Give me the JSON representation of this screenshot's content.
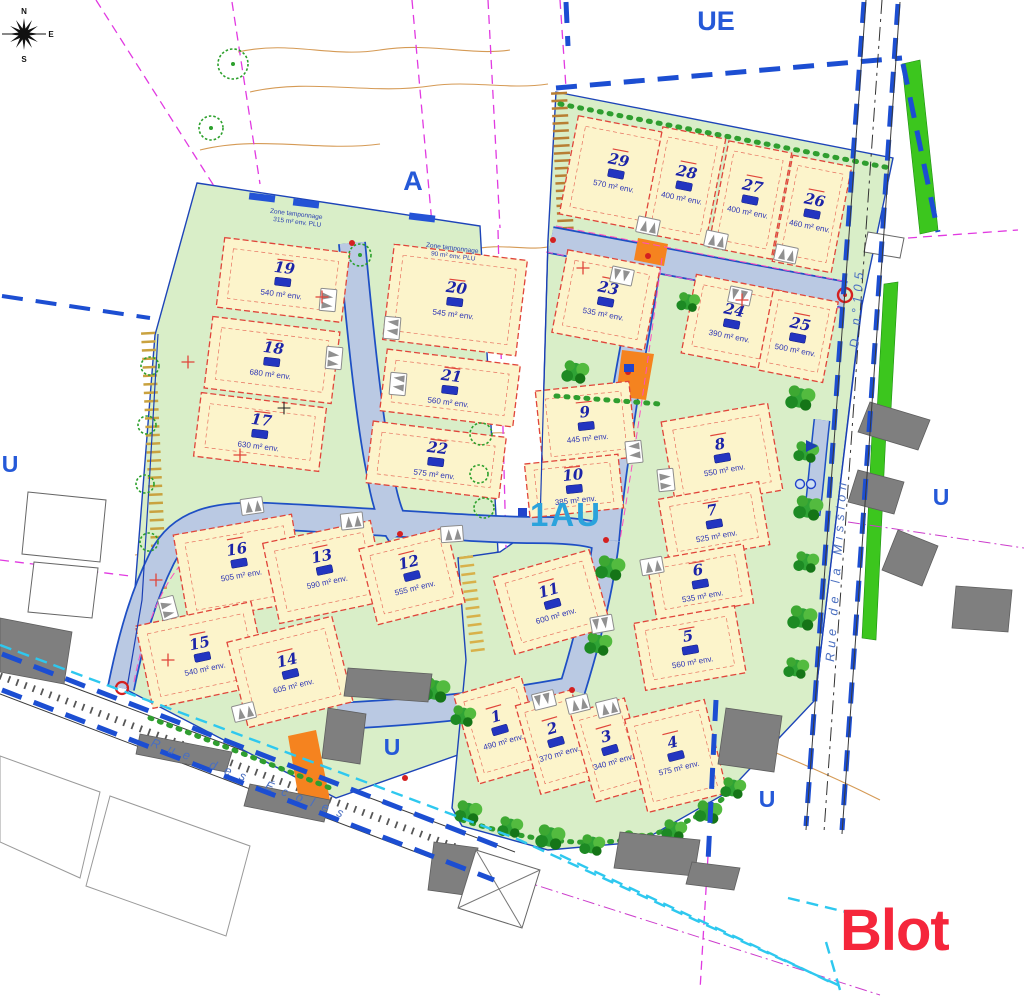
{
  "map": {
    "compass": {
      "n": "N",
      "e": "E",
      "s": "S",
      "o": "O"
    },
    "zones": {
      "ue": "UE",
      "a": "A",
      "u": "U",
      "one_au": "1AU"
    },
    "streets": {
      "ecoles": "Rue des Écoles",
      "mission": "Rue de la Mission",
      "route": "D n°105"
    },
    "annotations": {
      "buffer1_line1": "Zone tamponnage",
      "buffer1_line2": "315 m² env. PLU",
      "buffer2_line1": "Zone tamponnage",
      "buffer2_line2": "90 m² env. PLU"
    },
    "logo": "Blot",
    "colors": {
      "lot_fill": "#fcf4cb",
      "green": "#d9eec8",
      "road": "#bac9e3",
      "blue": "#1e4fc4",
      "red": "#e0453a",
      "magenta": "#e13ae1",
      "cyan": "#2ec8ef",
      "orange": "#f5831f",
      "logo_red": "#f5263b"
    }
  },
  "lots": [
    {
      "num": "1",
      "area": "490 m² env."
    },
    {
      "num": "2",
      "area": "370 m² env."
    },
    {
      "num": "3",
      "area": "340 m² env."
    },
    {
      "num": "4",
      "area": "575 m² env."
    },
    {
      "num": "5",
      "area": "560 m² env."
    },
    {
      "num": "6",
      "area": "535 m² env."
    },
    {
      "num": "7",
      "area": "525 m² env."
    },
    {
      "num": "8",
      "area": "550 m² env."
    },
    {
      "num": "9",
      "area": "445 m² env."
    },
    {
      "num": "10",
      "area": "385 m² env."
    },
    {
      "num": "11",
      "area": "600 m² env."
    },
    {
      "num": "12",
      "area": "555 m² env."
    },
    {
      "num": "13",
      "area": "590 m² env."
    },
    {
      "num": "14",
      "area": "605 m² env."
    },
    {
      "num": "15",
      "area": "540 m² env."
    },
    {
      "num": "16",
      "area": "505 m² env."
    },
    {
      "num": "17",
      "area": "630 m² env."
    },
    {
      "num": "18",
      "area": "680 m² env."
    },
    {
      "num": "19",
      "area": "540 m² env."
    },
    {
      "num": "20",
      "area": "545 m² env."
    },
    {
      "num": "21",
      "area": "560 m² env."
    },
    {
      "num": "22",
      "area": "575 m² env."
    },
    {
      "num": "23",
      "area": "535 m² env."
    },
    {
      "num": "24",
      "area": "390 m² env."
    },
    {
      "num": "25",
      "area": "500 m² env."
    },
    {
      "num": "26",
      "area": "460 m² env."
    },
    {
      "num": "27",
      "area": "400 m² env."
    },
    {
      "num": "28",
      "area": "400 m² env."
    },
    {
      "num": "29",
      "area": "570 m² env."
    }
  ]
}
